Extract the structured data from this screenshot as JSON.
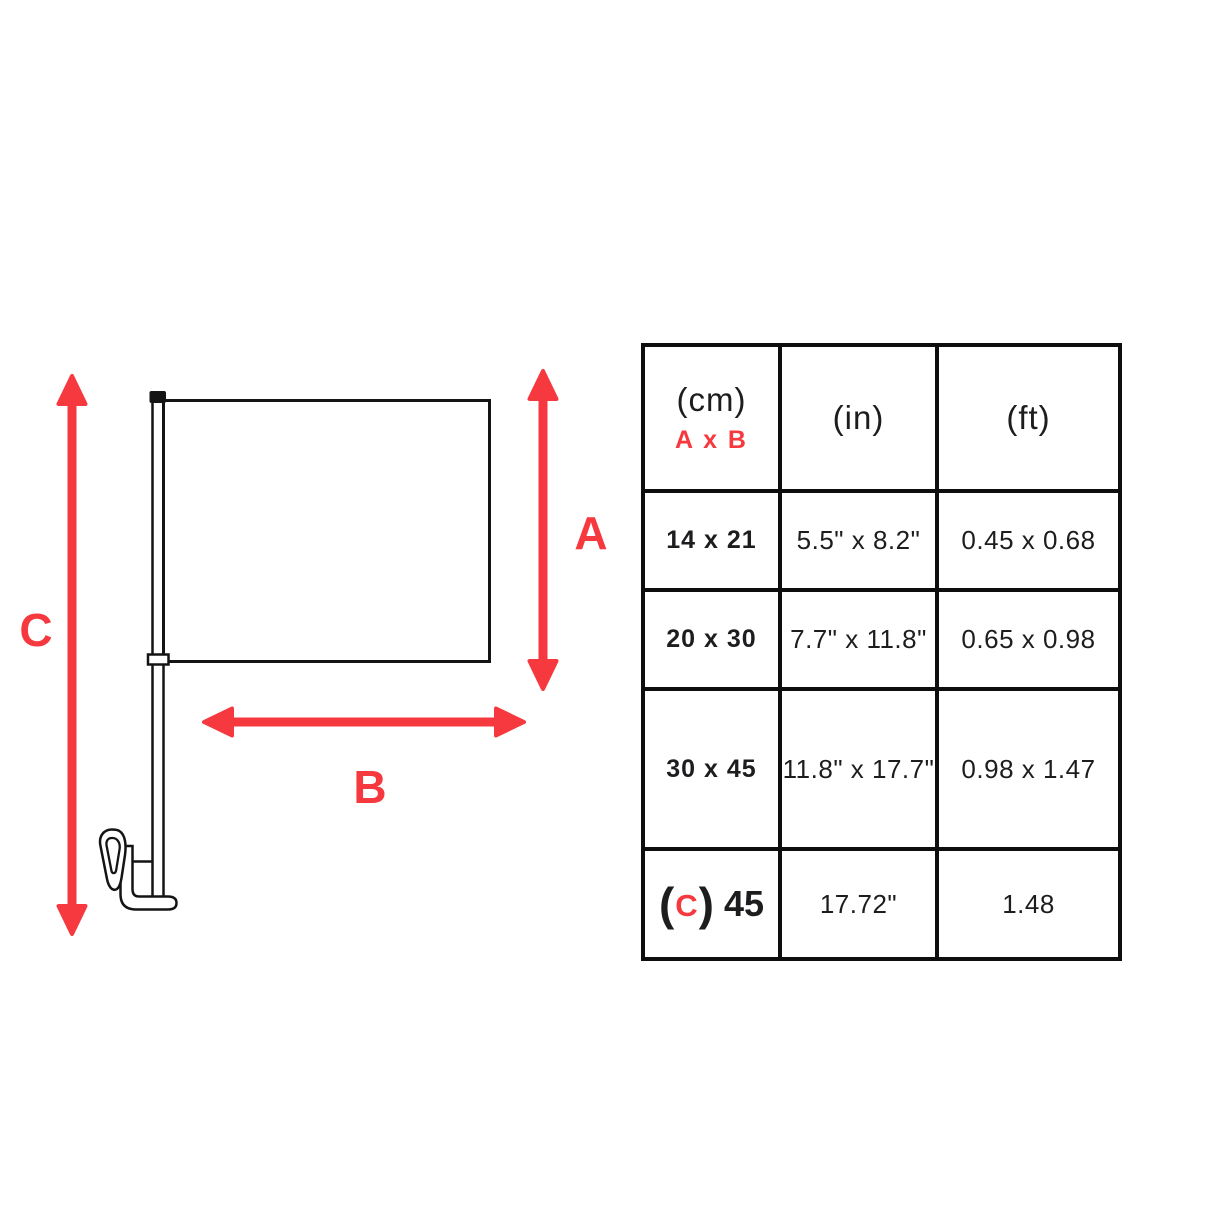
{
  "colors": {
    "accent": "#f6393e",
    "line": "#141414",
    "table_border": "#0e0e0e",
    "background": "#ffffff"
  },
  "diagram": {
    "labels": {
      "a": "A",
      "b": "B",
      "c": "C"
    },
    "icons": [
      "car-flag-graphic",
      "dimension-arrow-a",
      "dimension-arrow-b",
      "dimension-arrow-c"
    ]
  },
  "table": {
    "header": {
      "cm_unit": "(cm)",
      "axb_label": "A x B",
      "in_unit": "(in)",
      "ft_unit": "(ft)"
    },
    "rows": [
      {
        "cm": "14 x 21",
        "inches": "5.5\" x 8.2\"",
        "feet": "0.45 x 0.68"
      },
      {
        "cm": "20 x 30",
        "inches": "7.7\" x 11.8\"",
        "feet": "0.65 x 0.98"
      },
      {
        "cm": "30 x 45",
        "inches": "11.8\" x 17.7\"",
        "feet": "0.98 x 1.47"
      }
    ],
    "c_row": {
      "open_paren": "(",
      "c_letter": "C",
      "close_paren": ")",
      "value": "45",
      "inches": "17.72\"",
      "feet": "1.48"
    }
  }
}
